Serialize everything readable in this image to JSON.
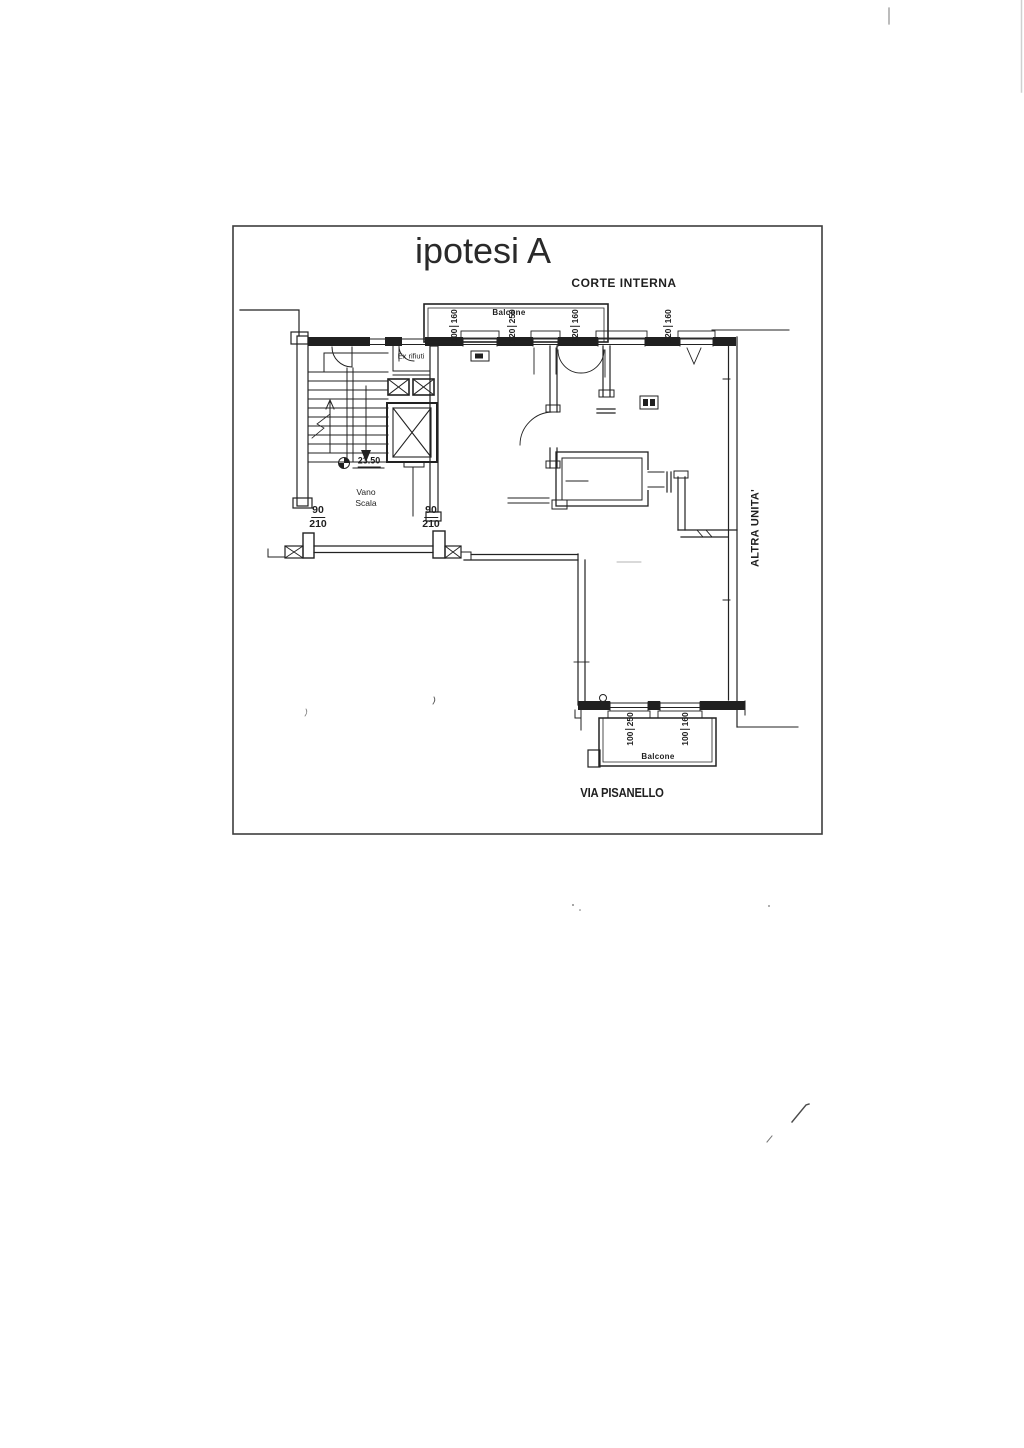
{
  "document": {
    "title": "ipotesi A",
    "labels": {
      "courtyard": "CORTE INTERNA",
      "street": "VIA PISANELLO",
      "adjacent_unit": "ALTRA UNITA'",
      "balcony_top": "Balcone",
      "balcony_bottom": "Balcone",
      "stairwell_line1": "Vano",
      "stairwell_line2": "Scala",
      "waste_room": "Ex rifiuti",
      "level_quota": "23.50"
    },
    "dimensions": {
      "doors": [
        {
          "width": "90",
          "height": "210"
        },
        {
          "width": "90",
          "height": "210"
        }
      ],
      "windows_top": [
        {
          "width": "100",
          "height": "160"
        },
        {
          "width": "120",
          "height": "250"
        },
        {
          "width": "120",
          "height": "160"
        },
        {
          "width": "120",
          "height": "160"
        }
      ],
      "windows_bottom": [
        {
          "width": "100",
          "height": "250"
        },
        {
          "width": "100",
          "height": "160"
        }
      ]
    },
    "colors": {
      "ink": "#1f1f1f",
      "frame": "#3d3d3d",
      "paper": "#ffffff"
    }
  }
}
